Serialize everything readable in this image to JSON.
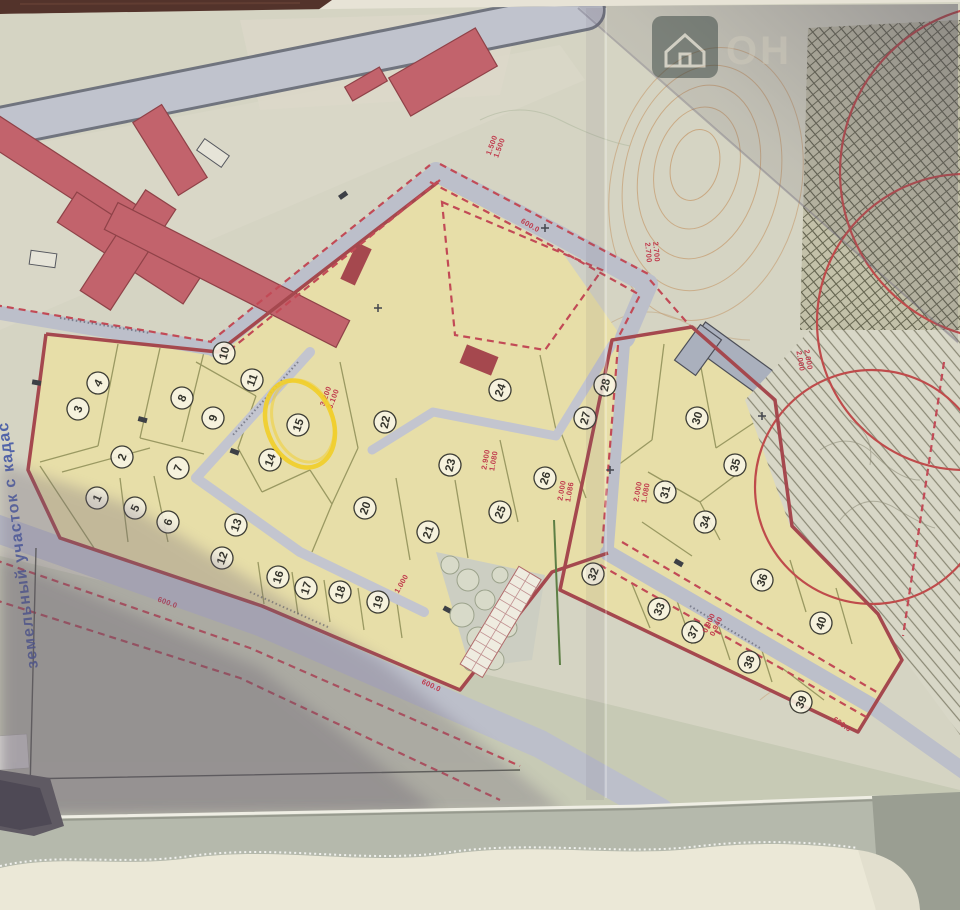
{
  "map": {
    "margin_note": {
      "text": "земельный участок с кадас"
    },
    "watermark": {
      "big_text": "ОН",
      "icon": "house-icon"
    },
    "highlight": {
      "plot": "15",
      "color": "#f1ce2a",
      "shape": "hand-drawn-ellipse"
    },
    "plots": [
      {
        "n": "1",
        "x": 97,
        "y": 498,
        "rot": -65
      },
      {
        "n": "2",
        "x": 122,
        "y": 457,
        "rot": -70
      },
      {
        "n": "3",
        "x": 78,
        "y": 409,
        "rot": -70
      },
      {
        "n": "4",
        "x": 98,
        "y": 383,
        "rot": -60
      },
      {
        "n": "5",
        "x": 135,
        "y": 508,
        "rot": -65
      },
      {
        "n": "6",
        "x": 168,
        "y": 522,
        "rot": -70
      },
      {
        "n": "7",
        "x": 178,
        "y": 468,
        "rot": -70
      },
      {
        "n": "8",
        "x": 182,
        "y": 398,
        "rot": -65
      },
      {
        "n": "9",
        "x": 213,
        "y": 418,
        "rot": -70
      },
      {
        "n": "10",
        "x": 224,
        "y": 353,
        "rot": -75
      },
      {
        "n": "11",
        "x": 252,
        "y": 380,
        "rot": -70
      },
      {
        "n": "12",
        "x": 222,
        "y": 558,
        "rot": -70
      },
      {
        "n": "13",
        "x": 236,
        "y": 525,
        "rot": -70
      },
      {
        "n": "14",
        "x": 270,
        "y": 460,
        "rot": -70
      },
      {
        "n": "15",
        "x": 298,
        "y": 425,
        "rot": -70
      },
      {
        "n": "16",
        "x": 278,
        "y": 577,
        "rot": -72
      },
      {
        "n": "17",
        "x": 306,
        "y": 588,
        "rot": -72
      },
      {
        "n": "18",
        "x": 340,
        "y": 592,
        "rot": -72
      },
      {
        "n": "19",
        "x": 378,
        "y": 602,
        "rot": -72
      },
      {
        "n": "20",
        "x": 365,
        "y": 508,
        "rot": -70
      },
      {
        "n": "21",
        "x": 428,
        "y": 532,
        "rot": -70
      },
      {
        "n": "22",
        "x": 385,
        "y": 422,
        "rot": -78
      },
      {
        "n": "23",
        "x": 450,
        "y": 465,
        "rot": -75
      },
      {
        "n": "24",
        "x": 500,
        "y": 390,
        "rot": -70
      },
      {
        "n": "25",
        "x": 500,
        "y": 512,
        "rot": -68
      },
      {
        "n": "26",
        "x": 545,
        "y": 478,
        "rot": -72
      },
      {
        "n": "27",
        "x": 585,
        "y": 418,
        "rot": -75
      },
      {
        "n": "28",
        "x": 605,
        "y": 385,
        "rot": -78
      },
      {
        "n": "30",
        "x": 697,
        "y": 418,
        "rot": -72
      },
      {
        "n": "31",
        "x": 665,
        "y": 492,
        "rot": -75
      },
      {
        "n": "32",
        "x": 593,
        "y": 574,
        "rot": -70
      },
      {
        "n": "33",
        "x": 659,
        "y": 609,
        "rot": -68
      },
      {
        "n": "34",
        "x": 705,
        "y": 522,
        "rot": -72
      },
      {
        "n": "35",
        "x": 735,
        "y": 465,
        "rot": -75
      },
      {
        "n": "36",
        "x": 762,
        "y": 580,
        "rot": -70
      },
      {
        "n": "37",
        "x": 693,
        "y": 632,
        "rot": -68
      },
      {
        "n": "38",
        "x": 749,
        "y": 662,
        "rot": -70
      },
      {
        "n": "39",
        "x": 801,
        "y": 702,
        "rot": -68
      },
      {
        "n": "40",
        "x": 821,
        "y": 623,
        "rot": -72
      }
    ],
    "dimension_labels": [
      {
        "lines": [
          "1.500",
          "1.500"
        ],
        "x": 494,
        "y": 146,
        "rot": -70
      },
      {
        "lines": [
          "600.0"
        ],
        "x": 531,
        "y": 224,
        "rot": 30
      },
      {
        "lines": [
          "2.700",
          "2.700"
        ],
        "x": 654,
        "y": 252,
        "rot": 85
      },
      {
        "lines": [
          "2.000",
          "2.000"
        ],
        "x": 806,
        "y": 360,
        "rot": 80
      },
      {
        "lines": [
          "3.200",
          "3.100"
        ],
        "x": 328,
        "y": 397,
        "rot": -70
      },
      {
        "lines": [
          "2.900",
          "1.080"
        ],
        "x": 488,
        "y": 460,
        "rot": -80
      },
      {
        "lines": [
          "2.000",
          "1.086"
        ],
        "x": 564,
        "y": 491,
        "rot": -80
      },
      {
        "lines": [
          "2.000",
          "1.080"
        ],
        "x": 640,
        "y": 492,
        "rot": -80
      },
      {
        "lines": [
          "0.900",
          "0.940"
        ],
        "x": 711,
        "y": 624,
        "rot": -65
      },
      {
        "lines": [
          "1.000"
        ],
        "x": 400,
        "y": 583,
        "rot": -60
      },
      {
        "lines": [
          "600.0"
        ],
        "x": 168,
        "y": 601,
        "rot": 20
      },
      {
        "lines": [
          "600.0"
        ],
        "x": 432,
        "y": 684,
        "rot": 25
      },
      {
        "lines": [
          "600.0"
        ],
        "x": 843,
        "y": 723,
        "rot": 35
      }
    ],
    "palette": {
      "paper": "#d5d4c3",
      "parcel_tan": "#e7dea8",
      "road_gray": "#bfc2cc",
      "boundary_solid_red": "#a5484e",
      "boundary_dash_red": "#c24a56",
      "building_red": "#c2636c",
      "building_gray": "#aab0bd",
      "parcel_line_olive": "#8d8d56",
      "highlight_yellow": "#f1ce2a",
      "margin_text_blue": "#3b51a5",
      "hatch_line": "#8a8874",
      "watermark_dark": "#273633"
    }
  }
}
